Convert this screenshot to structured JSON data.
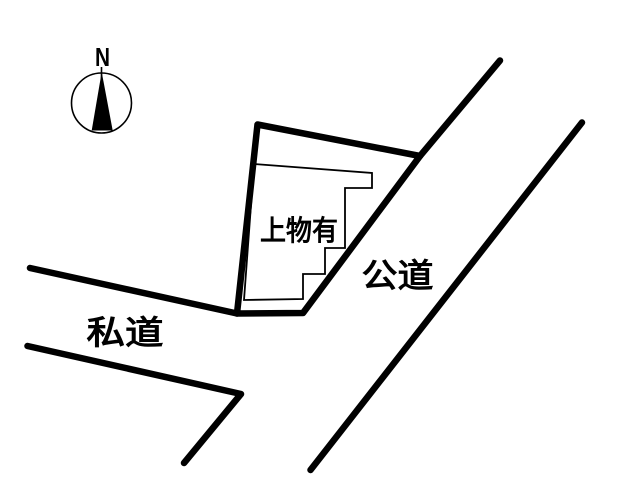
{
  "compass": {
    "north_label": "N"
  },
  "labels": {
    "building": "上物有",
    "public_road": "公道",
    "private_road": "私道"
  },
  "colors": {
    "ink": "#000000",
    "background": "#ffffff"
  }
}
